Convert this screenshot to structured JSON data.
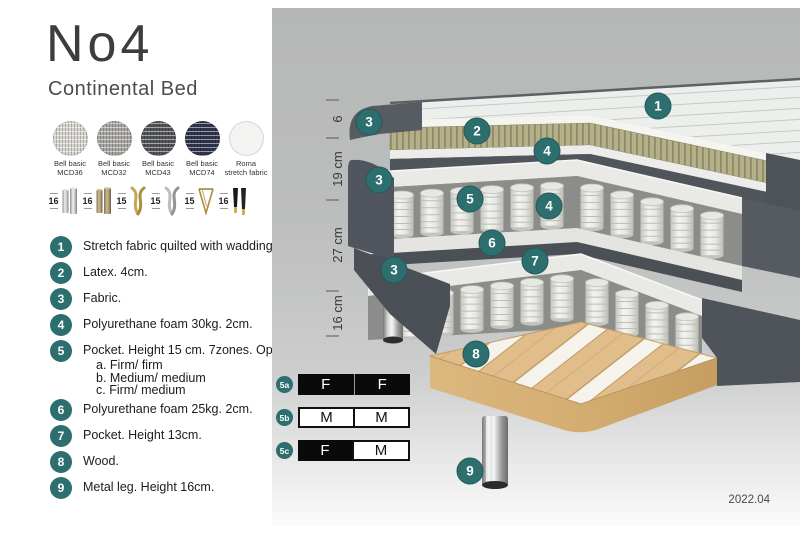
{
  "product": {
    "title": "No4",
    "subtitle": "Continental Bed"
  },
  "swatches": [
    {
      "line1": "Bell basic",
      "line2": "MCD36",
      "color": "#d8d6d0"
    },
    {
      "line1": "Bell basic",
      "line2": "MCD32",
      "color": "#a9a7a3"
    },
    {
      "line1": "Bell basic",
      "line2": "MCD43",
      "color": "#54555a"
    },
    {
      "line1": "Bell basic",
      "line2": "MCD74",
      "color": "#30364f"
    },
    {
      "line1": "Roma",
      "line2": "stretch fabric",
      "color": "#f3f3f2"
    }
  ],
  "legs": [
    {
      "height": "16",
      "type": "cylinder-chrome"
    },
    {
      "height": "16",
      "type": "cylinder-bronze"
    },
    {
      "height": "15",
      "type": "twisted-gold"
    },
    {
      "height": "15",
      "type": "twisted-silver"
    },
    {
      "height": "15",
      "type": "hairpin-gold"
    },
    {
      "height": "16",
      "type": "tapered-black-gold"
    }
  ],
  "spec_list": [
    {
      "num": "1",
      "text": "Stretch fabric quilted with wadding."
    },
    {
      "num": "2",
      "text": "Latex. 4cm."
    },
    {
      "num": "3",
      "text": "Fabric."
    },
    {
      "num": "4",
      "text": "Polyurethane foam 30kg. 2cm."
    },
    {
      "num": "5",
      "text": "Pocket. Height 15 cm. 7zones. Option:",
      "options": [
        "a. Firm/ firm",
        "b. Medium/ medium",
        "c. Firm/ medium"
      ]
    },
    {
      "num": "6",
      "text": "Polyurethane foam 25kg. 2cm."
    },
    {
      "num": "7",
      "text": "Pocket. Height 13cm."
    },
    {
      "num": "8",
      "text": "Wood."
    },
    {
      "num": "9",
      "text": "Metal leg. Height 16cm."
    }
  ],
  "firmness": [
    {
      "label": "5a",
      "left": "F",
      "right": "F"
    },
    {
      "label": "5b",
      "left": "M",
      "right": "M"
    },
    {
      "label": "5c",
      "left": "F",
      "right": "M"
    }
  ],
  "diagram": {
    "callouts": [
      "1",
      "3",
      "2",
      "4",
      "3",
      "5",
      "4",
      "6",
      "7",
      "3",
      "8",
      "9"
    ],
    "measurements": [
      "6",
      "19 cm",
      "27 cm",
      "16 cm"
    ],
    "version": "2022.04"
  },
  "colors": {
    "accent_teal": "#2d6e6e",
    "fabric_dark": "#51565e",
    "latex_olive": "#b5b08a",
    "wood": "#e0bd8a",
    "frame_white": "#e9e9e6",
    "panel_gray": "#bcbdbd",
    "firmness_dark": "#0a0a0a"
  }
}
